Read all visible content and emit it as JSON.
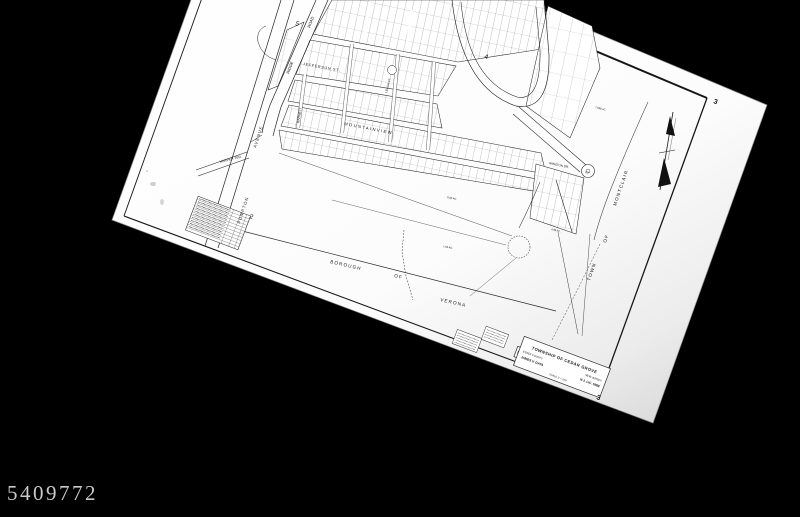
{
  "canvas": {
    "background": "#000000"
  },
  "watermark": {
    "id": "5409772",
    "color": "#c9c9c9"
  },
  "sheet": {
    "paper_color": "#fdfdfd",
    "ink_color": "#1a1a1a",
    "title_block": {
      "township": "TOWNSHIP OF CEDAR GROVE",
      "county": "ESSEX COUNTY",
      "state": "NEW JERSEY",
      "surveyor": "JAMES V. DATA",
      "license": "N.J. LIC. 5968",
      "scale": "SCALE 1\" = 100'"
    },
    "numbers": {
      "current_top": "3",
      "current_bottom": "3",
      "adjacent_top": "4",
      "adjacent_upper_left": "5",
      "adjacent_left": "2"
    },
    "boundaries": {
      "verona": {
        "w1": "BOROUGH",
        "w2": "OF",
        "w3": "VERONA"
      },
      "montclair": {
        "w1": "TOWN",
        "w2": "OF",
        "w3": "MONTCLAIR"
      }
    },
    "streets": {
      "ridge": "RIDGE",
      "road": "ROAD",
      "jefferson": "JEFFERSON ST.",
      "barnett": "BARNETT",
      "mountainview": "MOUNTAINVIEW",
      "leach": "LEACH CT.",
      "winston": "WINSTON DR.",
      "court": "CT.",
      "pompton": "POMPTON",
      "avenue": "AVENUE",
      "harper": "HARPER TER."
    },
    "acreage": {
      "a1": "7.638 AC.",
      "a2": "4.99 AC.",
      "a3": "5.06 AC.",
      "a4": "1.06 AC."
    }
  }
}
